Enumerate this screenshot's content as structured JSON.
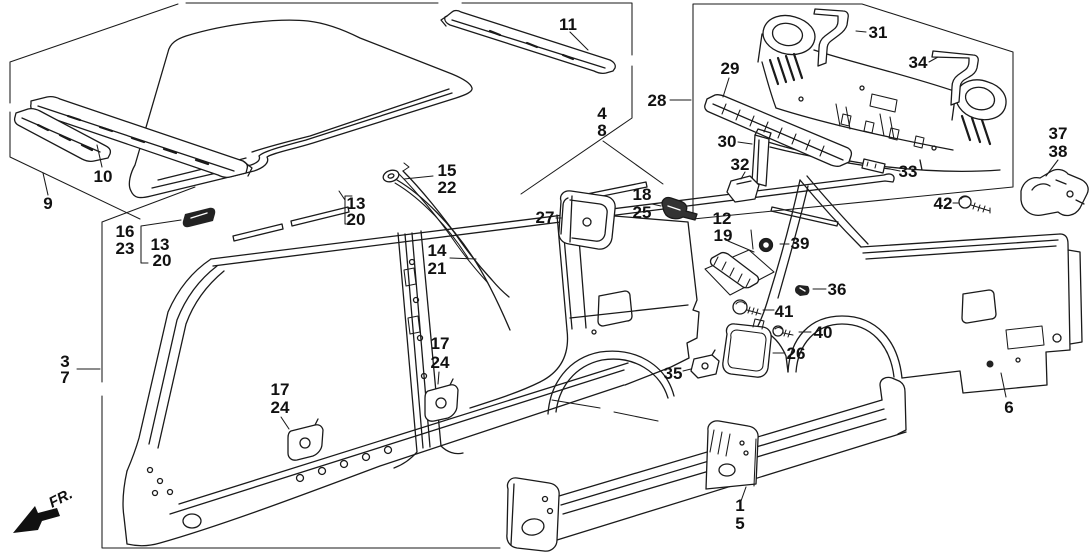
{
  "diagram": {
    "title_hint": "vehicle body outer panel exploded parts diagram",
    "background_color": "#ffffff",
    "line_color": "#1a1a1a",
    "fr_indicator": "FR.",
    "callouts": {
      "n1": "1",
      "n3": "3",
      "n4": "4",
      "n5": "5",
      "n6": "6",
      "n7": "7",
      "n8": "8",
      "n9": "9",
      "n10": "10",
      "n11": "11",
      "n12": "12",
      "n13_left": "13",
      "n13_mid": "13",
      "n14": "14",
      "n15": "15",
      "n16": "16",
      "n17_front": "17",
      "n17_rear": "17",
      "n18": "18",
      "n19": "19",
      "n20_left": "20",
      "n20_mid": "20",
      "n21": "21",
      "n22": "22",
      "n23": "23",
      "n24_front": "24",
      "n24_rear": "24",
      "n25": "25",
      "n26": "26",
      "n27": "27",
      "n28": "28",
      "n29": "29",
      "n30": "30",
      "n31": "31",
      "n32": "32",
      "n33": "33",
      "n34": "34",
      "n35": "35",
      "n36": "36",
      "n37": "37",
      "n38": "38",
      "n39": "39",
      "n40": "40",
      "n41": "41",
      "n42": "42"
    }
  }
}
